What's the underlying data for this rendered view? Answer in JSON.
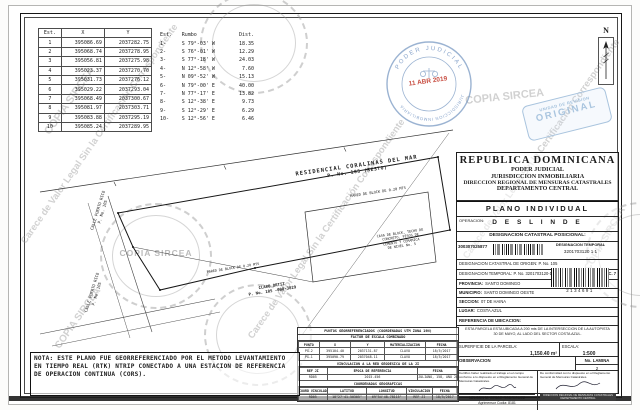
{
  "watermark": {
    "center": "COPIA SIRCEA",
    "diag": "Carece de Valor Legal Sin la Certificación Correspondiente"
  },
  "stamps": {
    "round_top": "PODER JUDICIAL",
    "round_bottom": "JURISDICCION INMOBILIARIA",
    "round_date": "11 ABR 2019",
    "rect_line1": "UNIDAD DE REVISION",
    "rect_line2": "ORIGINAL"
  },
  "coords_table": {
    "headers": [
      "Est.",
      "X",
      "Y"
    ],
    "rows": [
      [
        "1",
        "395086.69",
        "2037282.75"
      ],
      [
        "2",
        "395068.74",
        "2037278.95"
      ],
      [
        "3",
        "395056.81",
        "2037275.98"
      ],
      [
        "4",
        "395023.37",
        "2037270.70"
      ],
      [
        "5",
        "395031.73",
        "2037276.12"
      ],
      [
        "6",
        "395029.22",
        "2037293.04"
      ],
      [
        "7",
        "395068.49",
        "2037300.67"
      ],
      [
        "8",
        "395081.97",
        "2037303.71"
      ],
      [
        "9",
        "395083.88",
        "2037295.19"
      ],
      [
        "10",
        "395085.24",
        "2037289.95"
      ]
    ]
  },
  "bearings_table": {
    "headers": [
      "Est.",
      "Rumbo",
      "Dist."
    ],
    "rows": [
      [
        "1-",
        "S 79°-03' W",
        "18.35"
      ],
      [
        "2-",
        "S 76°-01' W",
        "12.29"
      ],
      [
        "3-",
        "S 77°-18' W",
        "24.03"
      ],
      [
        "4-",
        "N 12°-58' W",
        "7.60"
      ],
      [
        "5-",
        "N 09°-52' W",
        "15.13"
      ],
      [
        "6-",
        "N 79°-00' E",
        "40.00"
      ],
      [
        "7-",
        "N 77°-17' E",
        "13.82"
      ],
      [
        "8-",
        "S 12°-38' E",
        "9.73"
      ],
      [
        "9-",
        "S 12°-29' E",
        "6.29"
      ],
      [
        "10-",
        "S 12°-56' E",
        "6.46"
      ]
    ]
  },
  "drawing": {
    "north": "N",
    "residencial_line1": "RESIDENCIAL CORALINAS DEL MAR",
    "residencial_line2": "P. No. 105 (RESTO)",
    "pared_top": "PARED DE BLOCK DE 0.20 MTS",
    "pared_bottom": "PARED DE BLOCK DE 0.20 MTS",
    "house_lines": [
      "CASA DE BLOCK, TECHO DE",
      "CONCRETO, PISOS DE",
      "CEMENTO Y CERAMICA",
      "DE NIVEL No. 5"
    ],
    "calle_left_1": "CALLE PUERTO RICO",
    "calle_left_1_sub": "P. No. 105",
    "calle_left_2": "CALLE PUERTO RICO",
    "calle_left_2_sub": "P. No. 105",
    "owner_line1": "CLARO ORTIZ",
    "owner_line2": "P. No. 105 -000-3029"
  },
  "title_block": {
    "country": "REPUBLICA DOMINICANA",
    "line1": "PODER JUDICIAL",
    "line2": "JURISDICCION INMOBILIARIA",
    "line3": "DIRECCION REGIONAL DE MENSURAS CATASTRALES",
    "line4": "DEPARTAMENTO CENTRAL",
    "plano": "PLANO INDIVIDUAL",
    "operacion_label": "OPERACION:",
    "operacion_value": "D E S L I N D E",
    "dcp_label": "DESIGNACION CATASTRAL POSICIONAL:",
    "dcp_number": "300307025877",
    "dt_label": "DESIGNACION TEMPORAL",
    "dt_value": "3201703120 1 1",
    "origen": "DESIGNACION CATASTRAL DE ORIGEN: P. No. 105",
    "temporal": "DESIGNACION TEMPORAL: P. No. 3201703120-1-1",
    "dsl": "DSL B.C. 7",
    "provincia_label": "PROVINCIA:",
    "provincia_value": "SANTO DOMINGO",
    "municipio_label": "MUNICIPIO:",
    "municipio_value": "SANTO DOMINGO OESTE",
    "seccion_label": "SECCION:",
    "seccion_value": "07 DE HAINA",
    "lugar_label": "LUGAR:",
    "lugar_value": "COSTA AZUL",
    "barcode_number": "2134691",
    "ref_label": "REFERENCIA DE UBICACION:",
    "ref_text": "ESTA PARCELA ESTA UBICADA A 200 mts DE LA INTERSECCION DE LA AUTOPISTA 30 DE MAYO, AL LADO DEL SECTOR COSTA AZUL.",
    "superficie_label": "SUPERFICIE DE LA PARCELA:",
    "superficie_value": "1,150.40 m²",
    "escala_label": "ESCALA:",
    "escala_value": "1:500",
    "observacion_label": "OBSERVACION",
    "lamina_label": "No. LAMINA",
    "lamina_value": "2",
    "cert_left_text": "Certifico haber realizado el trabajo en el campo conforme a lo dispuesto en el Reglamento General de Mensuras Catastrales.",
    "cert_left_name": "NELSON M. CESAR RODRIGUEZ",
    "cert_left_code": "Agrimensor Codia: 8181",
    "cert_right_text": "De conformidad con lo dispuesto en el Reglamento General de Mensuras Catastrales.",
    "cert_right_stamp1": "DIRECCION REGIONAL DE MENSURAS CATASTRALES",
    "cert_right_stamp2": "DEPARTAMENTO CENTRAL"
  },
  "georef_table": {
    "title": "PUNTOS GEORREFERENCIADOS (COORDENADAS UTM ZONA 19N)",
    "subtitle": "FACTOR DE ESCALA COMBINADO",
    "utm_headers": [
      "PUNTO",
      "X",
      "Y",
      "MATERIALIZACION",
      "FECHA"
    ],
    "utm_rows": [
      [
        "PG-2",
        "395104.40",
        "2037131.87",
        "CLAVO",
        "18/5/2017"
      ],
      [
        "PG-1",
        "395090.79",
        "2037048.11",
        "CLAVO",
        "18/5/2017"
      ]
    ],
    "vinc_title": "VINCULACION A LA RED GEODESICA DE LA JI",
    "vinc_headers": [
      "REF JI",
      "EPOCA DE REFERENCIA",
      "FECHA"
    ],
    "vinc_rows": [
      [
        "RD05",
        "2015.456",
        "JULIANO, 158, AÑO 2015"
      ]
    ],
    "geo_title": "COORDENADAS GEOGRAFICAS",
    "geo_headers": [
      "COORD VINCULADA",
      "LATITUD",
      "LONGITUD",
      "VINCULACION",
      "FECHA"
    ],
    "geo_rows": [
      [
        "RD05",
        "18°27'41.50305\"",
        "69°54'48.78115\"",
        "REF JI",
        "18/5/2017"
      ]
    ]
  },
  "nota": {
    "text": "NOTA: ESTE PLANO FUE GEORREFERENCIADO POR EL METODO LEVANTAMIENTO EN TIEMPO REAL (RTK) NTRIP CONECTADO A UNA ESTACION DE REFERENCIA DE OPERACION CONTINUA (CORS)."
  }
}
